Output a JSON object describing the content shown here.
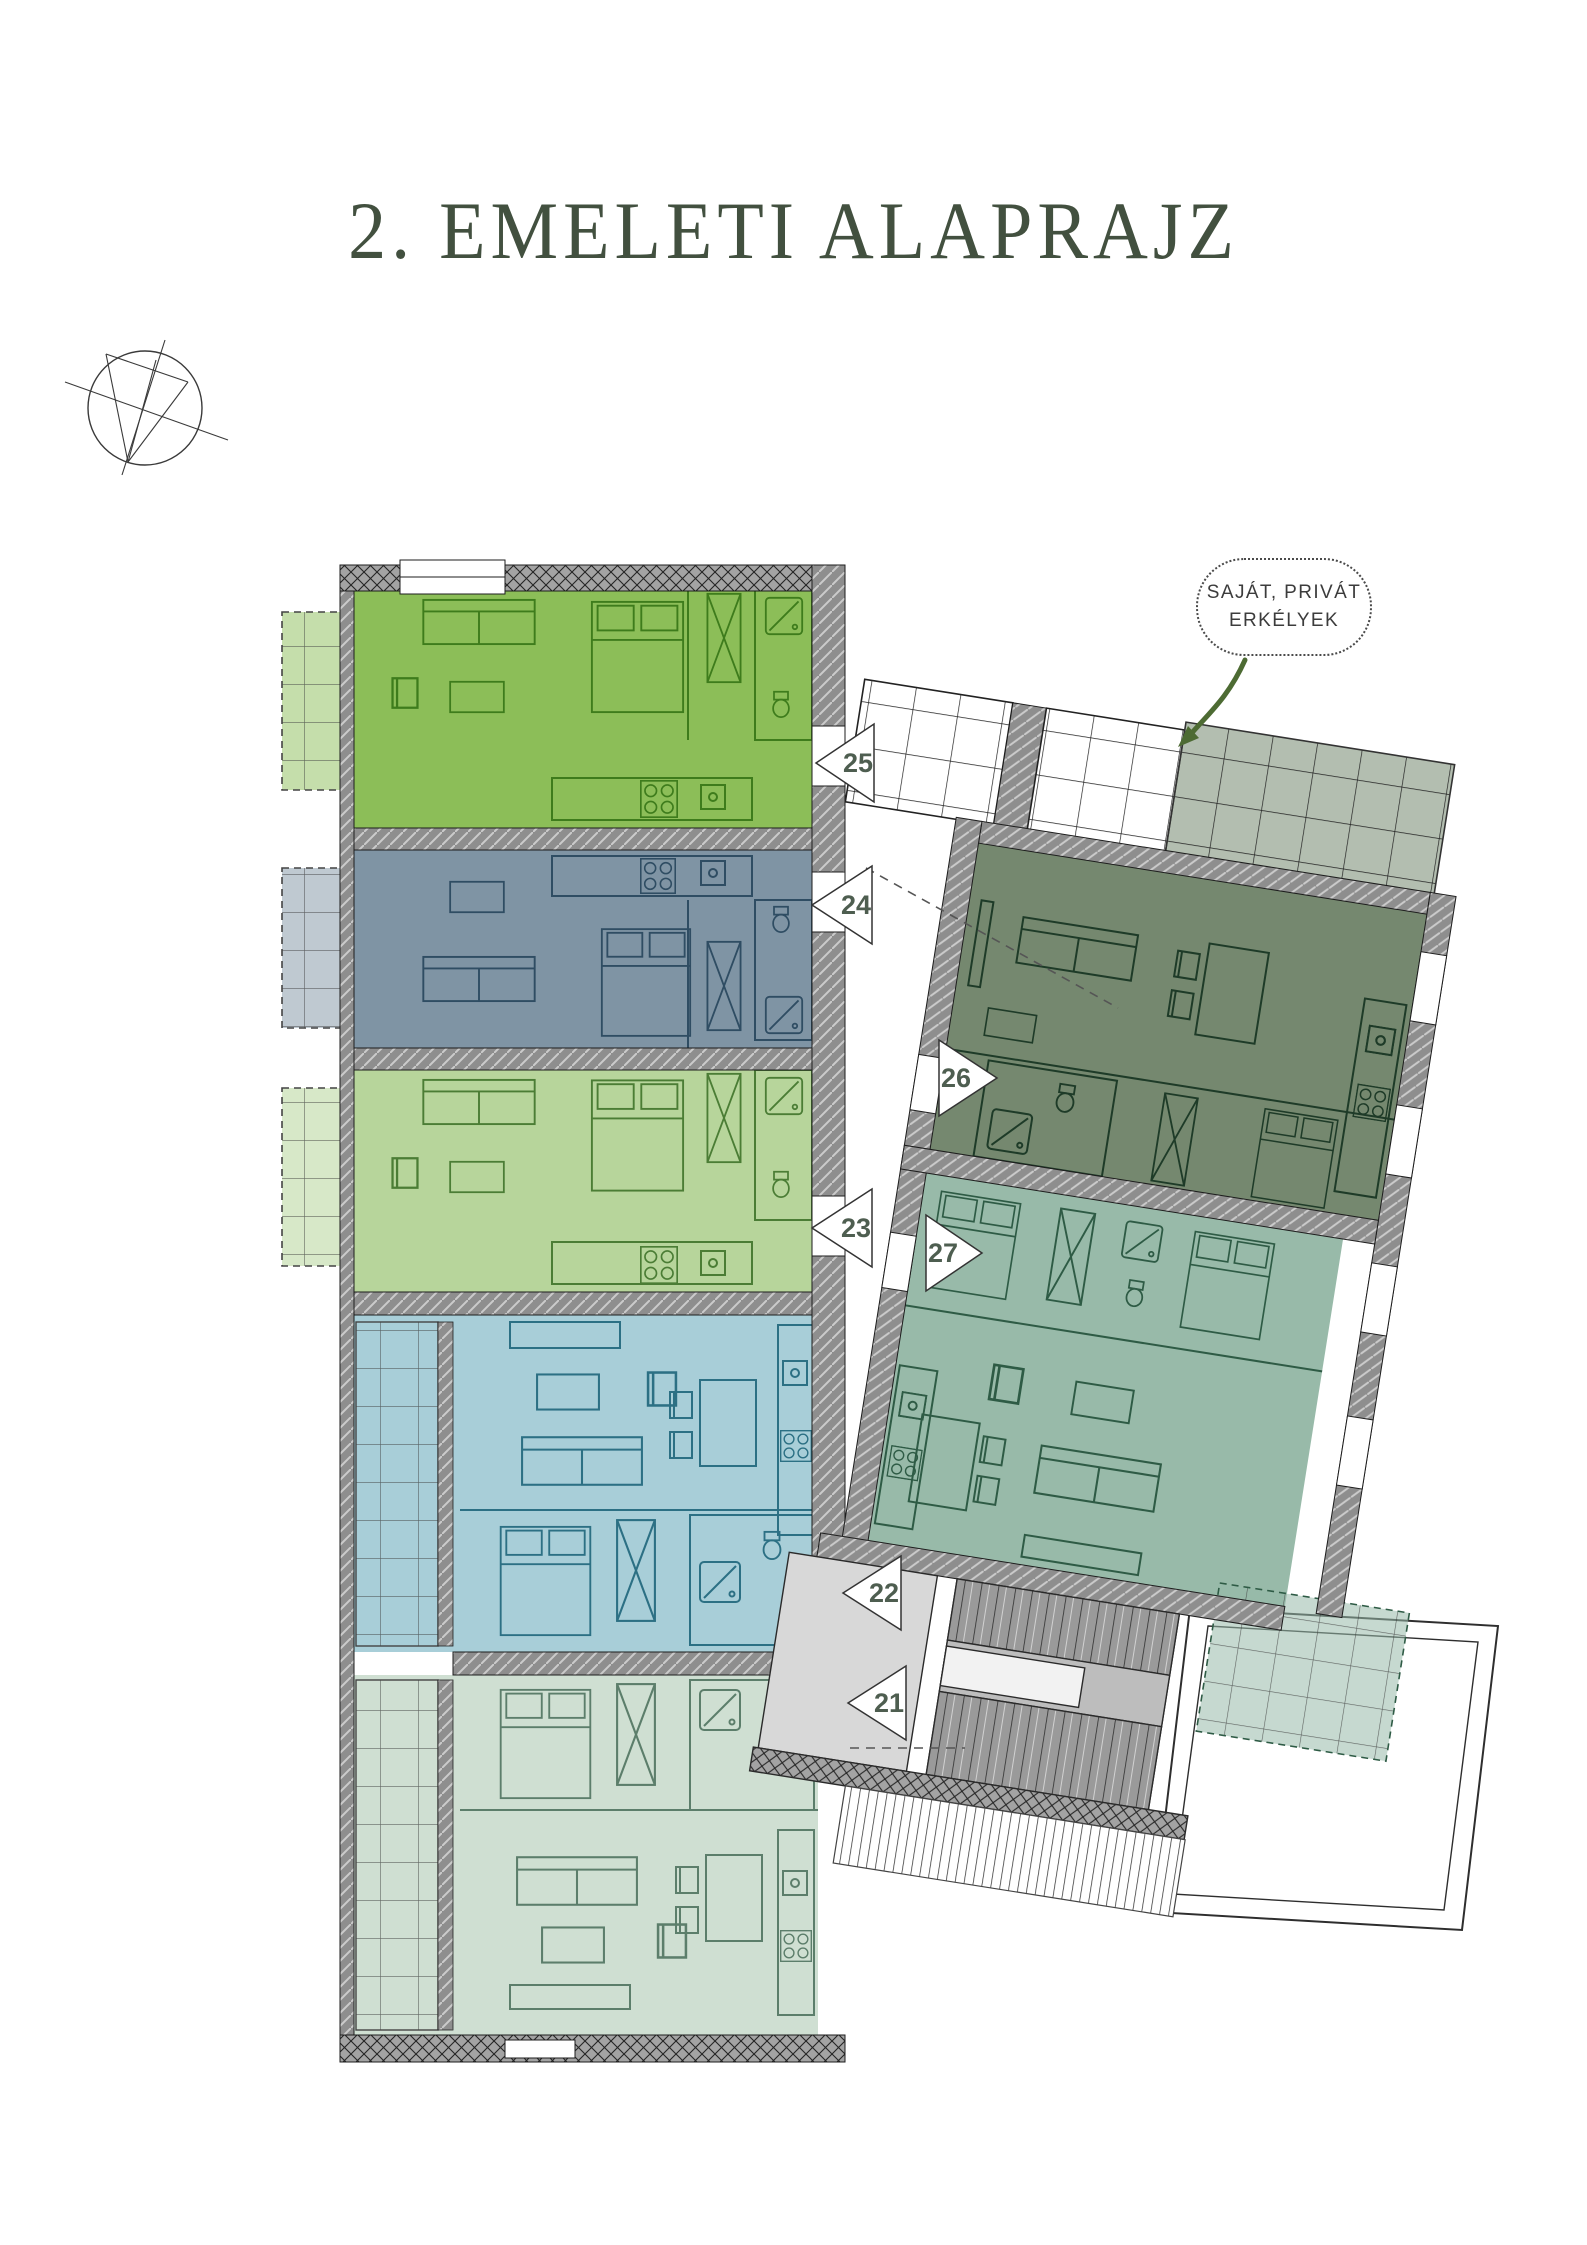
{
  "page": {
    "title": "2. EMELETI ALAPRAJZ",
    "title_color": "#42503f",
    "background": "#ffffff"
  },
  "callout": {
    "line1": "SAJÁT, PRIVÁT",
    "line2": "ERKÉLYEK",
    "arrow_color": "#4d6b33"
  },
  "plan": {
    "label_color": "#4e5e50",
    "wall_color": "#8e8e8e",
    "corridor_color": "#ffffff",
    "stair_color": "#c9c9c9",
    "units": [
      {
        "number": "21",
        "name": "apartment-21",
        "fill": "#cfdfd2",
        "stroke": "#5c7e6b",
        "wing": "left"
      },
      {
        "number": "22",
        "name": "apartment-22",
        "fill": "#a8ced8",
        "stroke": "#2c7084",
        "wing": "left"
      },
      {
        "number": "23",
        "name": "apartment-23",
        "fill": "#b7d59b",
        "stroke": "#4b7d35",
        "wing": "left"
      },
      {
        "number": "24",
        "name": "apartment-24",
        "fill": "#7f94a4",
        "stroke": "#2f4d63",
        "wing": "left"
      },
      {
        "number": "25",
        "name": "apartment-25",
        "fill": "#8cbe58",
        "stroke": "#3e7c1c",
        "wing": "left"
      },
      {
        "number": "26",
        "name": "apartment-26",
        "fill": "#75886f",
        "stroke": "#1e3b28",
        "wing": "right"
      },
      {
        "number": "27",
        "name": "apartment-27",
        "fill": "#98baa9",
        "stroke": "#2e5b45",
        "wing": "right"
      }
    ]
  }
}
